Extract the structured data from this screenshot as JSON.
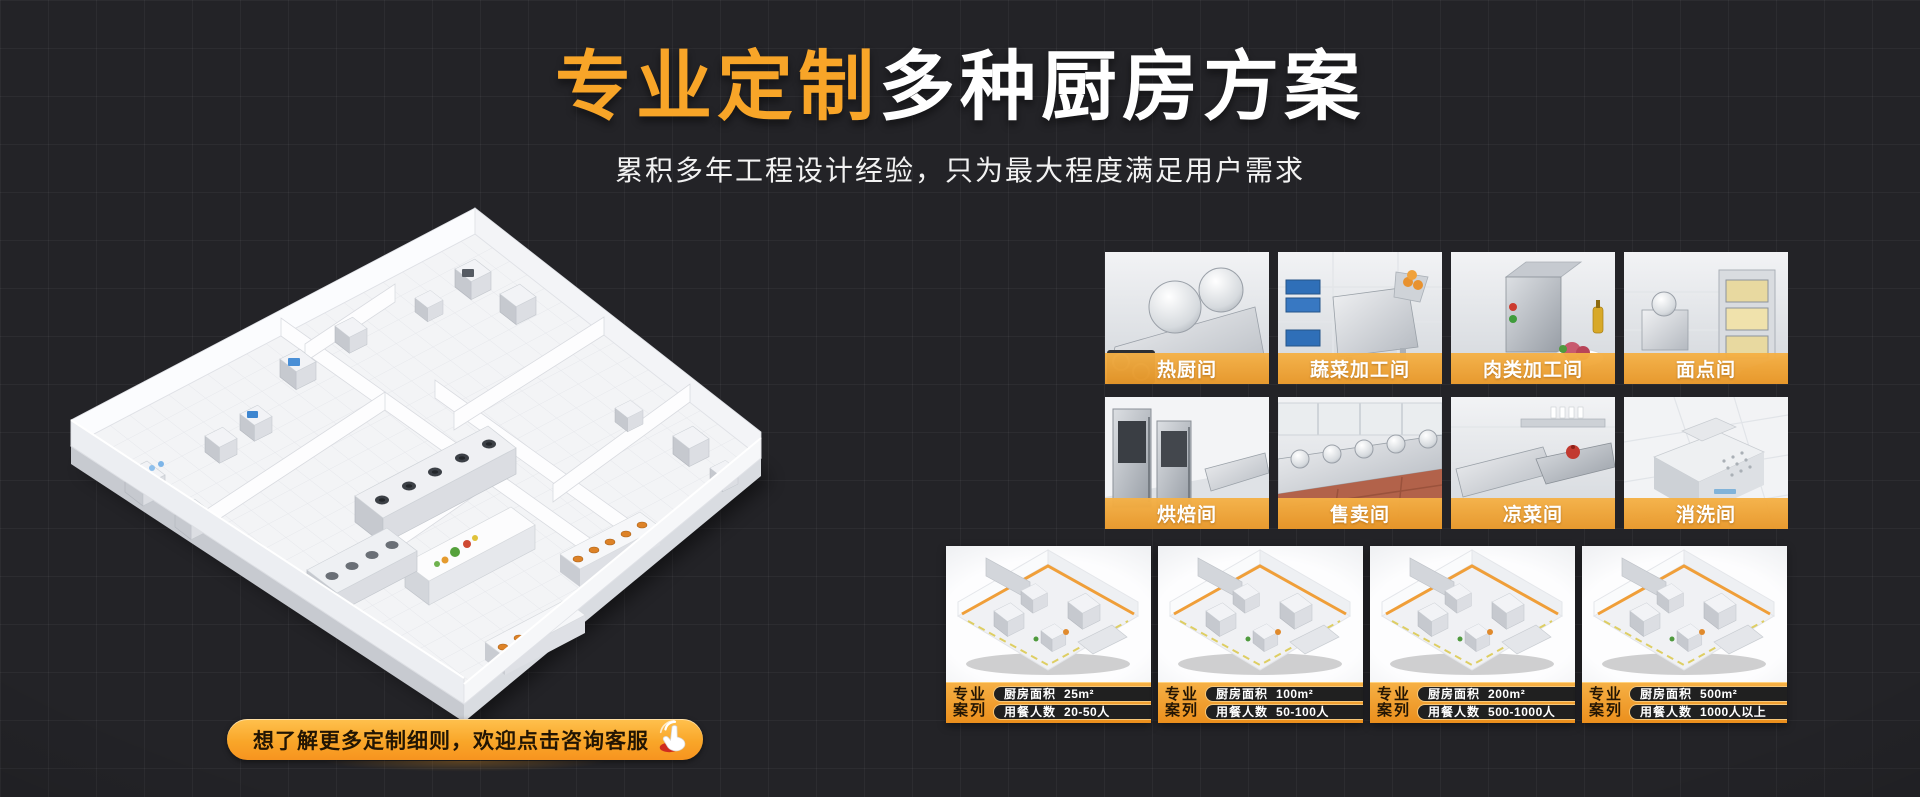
{
  "hero": {
    "title_highlight": "专业定制",
    "title_rest": "多种厨房方案",
    "subtitle": "累积多年工程设计经验，只为最大程度满足用户需求"
  },
  "cta": {
    "label": "想了解更多定制细则，欢迎点击咨询客服",
    "icon": "hand-click-icon"
  },
  "rooms": [
    {
      "label": "热厨间"
    },
    {
      "label": "蔬菜加工间"
    },
    {
      "label": "肉类加工间"
    },
    {
      "label": "面点间"
    },
    {
      "label": "烘焙间"
    },
    {
      "label": "售卖间"
    },
    {
      "label": "凉菜间"
    },
    {
      "label": "消洗间"
    }
  ],
  "cases": [
    {
      "tag_line1": "专业",
      "tag_line2": "案列",
      "area_label": "厨房面积",
      "area_value": "25m²",
      "diners_label": "用餐人数",
      "diners_value": "20-50人"
    },
    {
      "tag_line1": "专业",
      "tag_line2": "案列",
      "area_label": "厨房面积",
      "area_value": "100m²",
      "diners_label": "用餐人数",
      "diners_value": "50-100人"
    },
    {
      "tag_line1": "专业",
      "tag_line2": "案列",
      "area_label": "厨房面积",
      "area_value": "200m²",
      "diners_label": "用餐人数",
      "diners_value": "500-1000人"
    },
    {
      "tag_line1": "专业",
      "tag_line2": "案列",
      "area_label": "厨房面积",
      "area_value": "500m²",
      "diners_label": "用餐人数",
      "diners_value": "1000人以上"
    }
  ],
  "colors": {
    "accent_orange": "#F8A528",
    "banner_orange": "#EFA43C",
    "background": "#232327",
    "pill_background": "#202020",
    "text_white": "#FFFFFF"
  }
}
